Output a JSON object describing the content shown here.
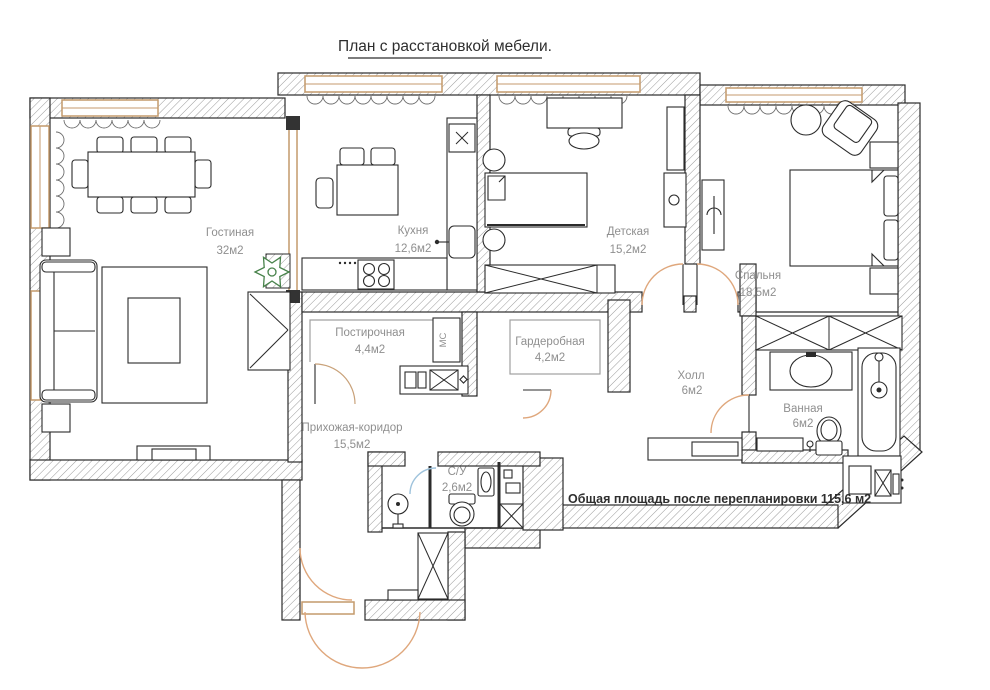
{
  "title": "План с расстановкой мебели.",
  "note": "Общая площадь после перепланировки 115,6 м2",
  "rooms": {
    "living": {
      "name": "Гостиная",
      "area": "32м2"
    },
    "kitchen": {
      "name": "Кухня",
      "area": "12,6м2"
    },
    "kids": {
      "name": "Детская",
      "area": "15,2м2"
    },
    "bedroom": {
      "name": "Спальня",
      "area": "18,5м2"
    },
    "laundry": {
      "name": "Постирочная",
      "area": "4,4м2"
    },
    "wardrobe": {
      "name": "Гардеробная",
      "area": "4,2м2"
    },
    "hall": {
      "name": "Холл",
      "area": "6м2"
    },
    "bathroom": {
      "name": "Ванная",
      "area": "6м2"
    },
    "corridor": {
      "name": "Прихожая-коридор",
      "area": "15,5м2"
    },
    "wc": {
      "name": "С/У",
      "area": "2,6м2"
    }
  },
  "labels": {
    "washer_column": "МС"
  },
  "colors": {
    "wall_line": "#2b2b2b",
    "hatch": "#9a9a9a",
    "window_frame": "#c49a6c",
    "door_arc": "#dfa77c",
    "shower_door_arc": "#9fc3dc",
    "plant": "#47824a",
    "room_label": "#8f8f8f",
    "text": "#2e2e2e"
  }
}
